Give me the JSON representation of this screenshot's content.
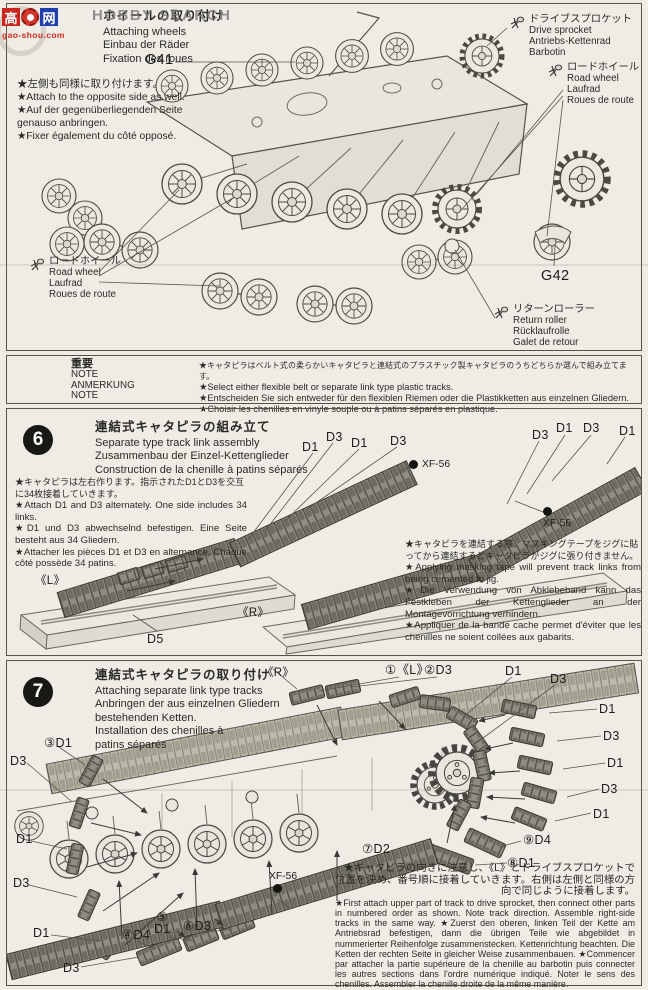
{
  "watermark": {
    "logo_hi": "高",
    "logo_net": "网",
    "logo_domain": "gao-shou.com",
    "brand": "HOBBY SEARCH"
  },
  "step5": {
    "title": {
      "ja": "ホイールの取り付け",
      "en": "Attaching wheels",
      "de": "Einbau der Räder",
      "fr": "Fixation des roues"
    },
    "notes": [
      "★左側も同様に取り付けます。",
      "★Attach to the opposite side as well.",
      "★Auf der gegenüberliegenden Seite genauso anbringen.",
      "★Fixer également du côté opposé."
    ],
    "parts": {
      "g41": "G41",
      "g42": "G42"
    },
    "callouts": {
      "drive_sprocket": {
        "ja": "ドライブスプロケット",
        "en": "Drive sprocket",
        "de": "Antriebs-Kettenrad",
        "fr": "Barbotin"
      },
      "road_wheel_right": {
        "ja": "ロードホイール",
        "en": "Road wheel",
        "de": "Laufrad",
        "fr": "Roues de route"
      },
      "road_wheel_left": {
        "ja": "ロードホイール",
        "en": "Road wheel",
        "de": "Laufrad",
        "fr": "Roues de route"
      },
      "return_roller": {
        "ja": "リターンローラー",
        "en": "Return roller",
        "de": "Rücklaufrolle",
        "fr": "Galet de retour"
      }
    }
  },
  "note_box": {
    "headers": [
      "重要",
      "NOTE",
      "ANMERKUNG",
      "NOTE"
    ],
    "lines": [
      "★キャタピラはベルト式の柔らかいキャタピラと連結式のプラスチック製キャタピラのうちどちらか選んで組み立てます。",
      "★Select either flexible belt or separate link type plastic tracks.",
      "★Entscheiden Sie sich entweder für den flexiblen Riemen oder die Plastikketten aus einzelnen Gliedern.",
      "★Choisir les chenilles en vinyle souple ou à patins séparés en plastique."
    ]
  },
  "step6": {
    "number": "6",
    "title": {
      "ja": "連結式キャタピラの組み立て",
      "en": "Separate type track link assembly",
      "de": "Zusammenbau der Einzel-Kettenglieder",
      "fr": "Construction de la chenille à patins séparés"
    },
    "notes": [
      "★キャタピラは左右作ります。指示されたD1とD3を交互に34枚接着していきます。",
      "★Attach D1 and D3 alternately. One side includes 34 links.",
      "★D1 und D3 abwechselnd befestigen. Eine Seite besteht aus 34 Gliedern.",
      "★Attacher les pièces D1 et D3 en alternance. Chaque côté possède 34 patins."
    ],
    "tip": [
      "★キャタピラを連結する際、マスキングテープをジグに貼ってから連結するとキャタピラがジグに張り付きません。",
      "★Applying masking tape will prevent track links from being cemented to jig.",
      "★Die Verwendung von Abklebeband kann das Festkleben der Kettenglieder an der Montagevorrichtung verhindern.",
      "★Appliquer de la bande cache permet d'éviter que les chenilles ne soient collées aux gabarits."
    ],
    "labels": {
      "l": "《L》",
      "r": "《R》",
      "d5": "D5",
      "xf": "XF-56",
      "left_group": [
        "D1",
        "D3",
        "D1",
        "D3"
      ],
      "right_group": [
        "D3",
        "D1",
        "D3",
        "D1"
      ]
    }
  },
  "step7": {
    "number": "7",
    "title": {
      "ja": "連結式キャタピラの取り付け",
      "en": "Attaching separate link type tracks",
      "de": "Anbringen der aus einzelnen Gliedern bestehenden Ketten.",
      "fr": "Installation des chenilles à patins séparés"
    },
    "labels": {
      "r": "《R》",
      "s1": "①《L》",
      "s2": "②D3",
      "s3": "③D1",
      "s4": "④D4",
      "s5": "⑤",
      "s5b": "D1",
      "s6": "⑥D3",
      "s7": "⑦D2",
      "s8": "⑧D1",
      "s9": "⑨D4",
      "xf": "XF-56",
      "sprocket_top": [
        "D1",
        "D3"
      ],
      "right_col": [
        "D1",
        "D3",
        "D1",
        "D3",
        "D1"
      ],
      "left_col": [
        "D1",
        "D3",
        "D1",
        "D3"
      ]
    },
    "note_ja": "★キャタピラの向きに注意し、《L》とドライブスプロケットで位置を決め、番号順に接着していきます。右側は左側と同様の方向で同じように接着します。",
    "note_latin": "★First attach upper part of track to drive sprocket, then connect other parts in numbered order as shown. Note track direction. Assemble right-side tracks in the same way. ★Zuerst den oberen, linken Teil der Kette am Antriebsrad befestigen, dann die übrigen Teile wie abgebildet in nummerierter Reihenfolge zusammenstecken. Kettenrichtung beachten. Die Ketten der rechten Seite in gleicher Weise zusammenbauen. ★Commencer par attacher la partie supérieure de la chenille au barbotin puis connecter les autres sections dans l'ordre numérique indiqué. Noter le sens des chenilles. Assembler la chenille droite de la même manière."
  }
}
